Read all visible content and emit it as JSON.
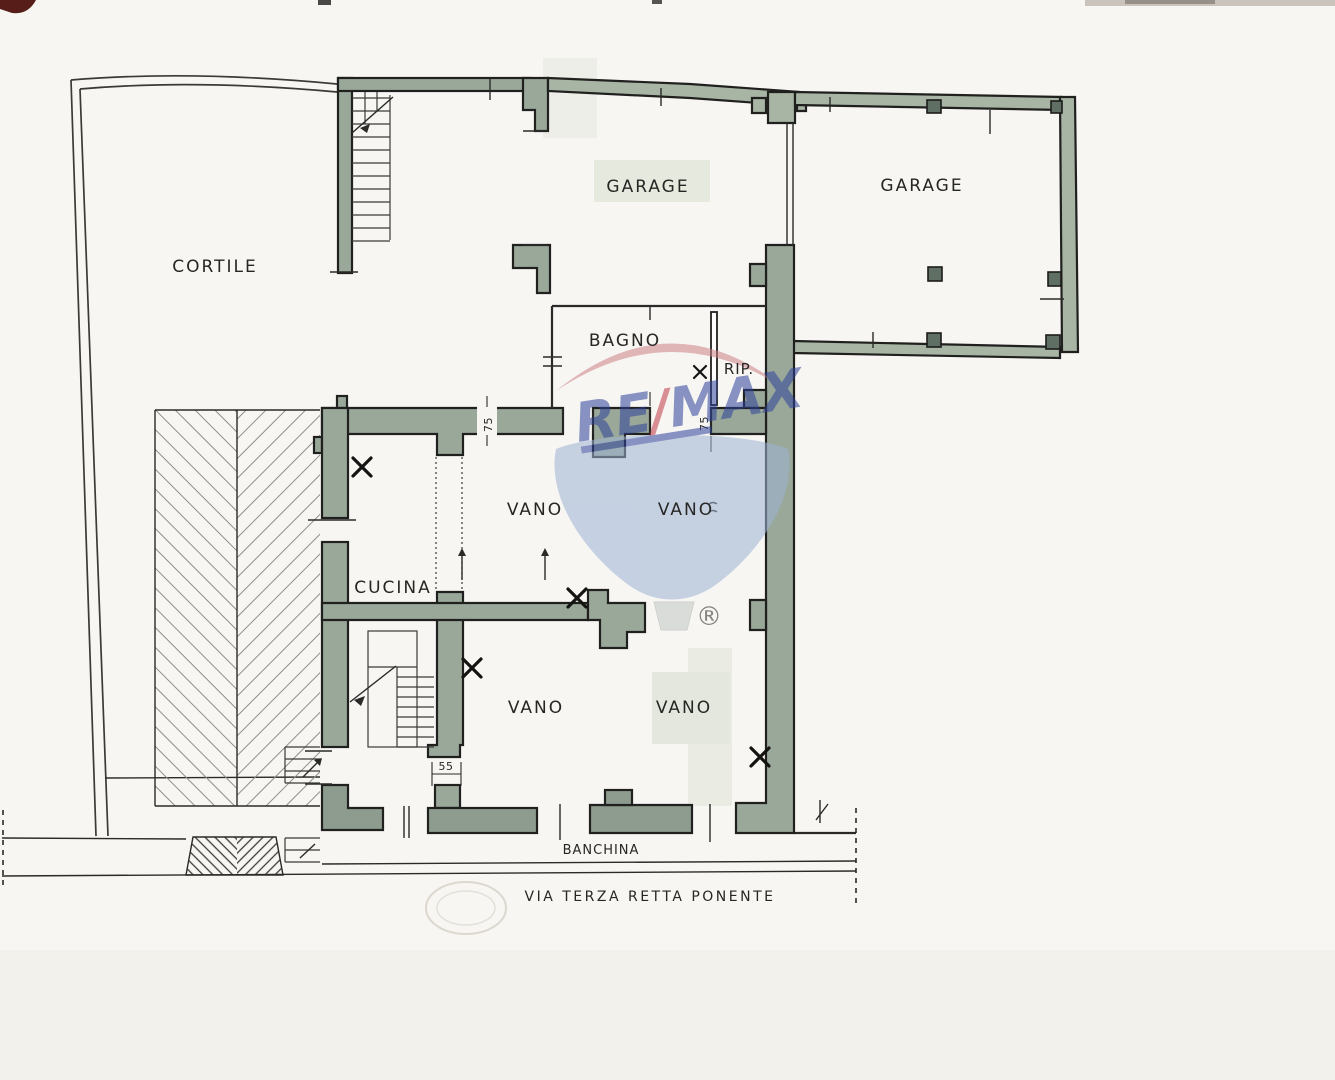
{
  "rooms": {
    "cortile": "CORTILE",
    "garage_left": "GARAGE",
    "garage_right": "GARAGE",
    "bagno": "BAGNO",
    "rip": "RIP.",
    "vano_nw": "VANO",
    "vano_ne": "VANO",
    "cucina": "CUCINA",
    "vano_sw": "VANO",
    "vano_se": "VANO"
  },
  "annotations": {
    "banchina": "BANCHINA",
    "street_name": "VIA TERZA RETTA PONENTE"
  },
  "dimensions": {
    "opening_left": "75",
    "opening_right": "75",
    "wall_bottom": "55"
  },
  "watermark": {
    "brand_re": "RE",
    "brand_slash": "/",
    "brand_max": "MAX",
    "registered": "®",
    "colors": {
      "logo_blue": "#2e429b",
      "logo_red": "#c03a45",
      "balloon_red": "#cf8186",
      "balloon_blue": "#9db3d3"
    }
  },
  "colors": {
    "wall_green": "#9aa89a",
    "paper": "#f7f6f3"
  }
}
